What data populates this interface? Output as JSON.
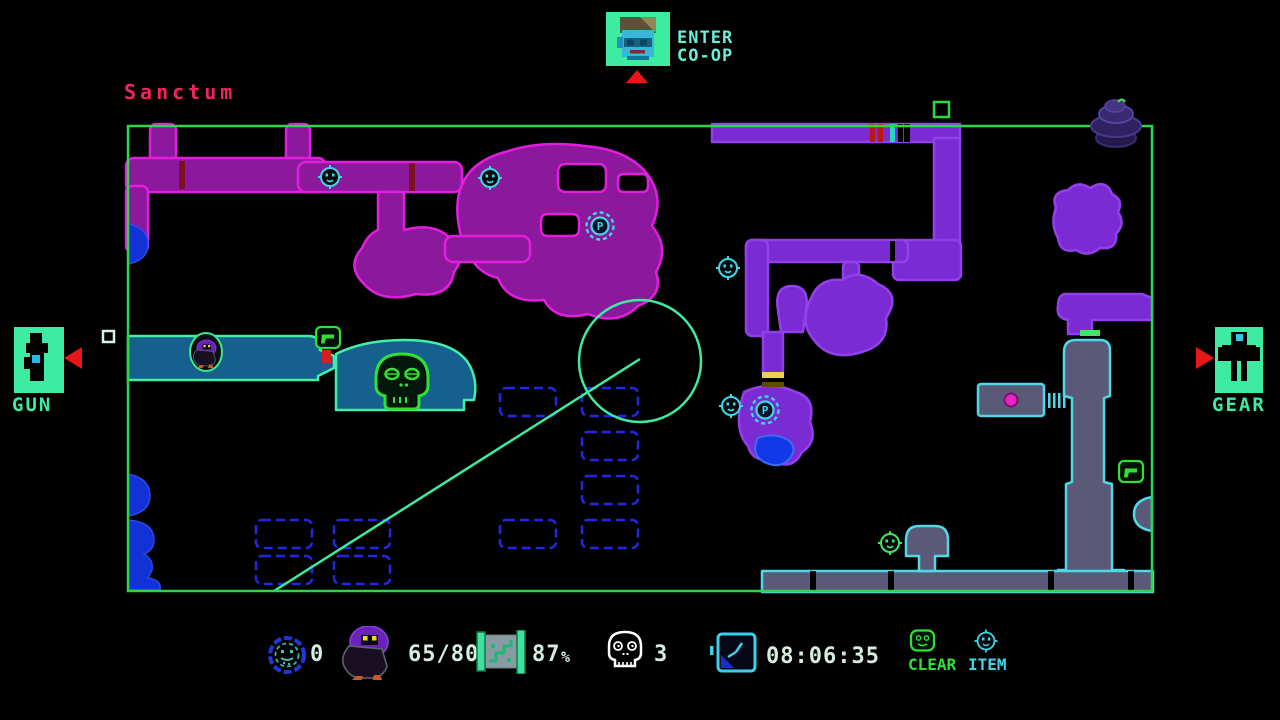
{
  "header": {
    "area_name": "Sanctum",
    "coop_line1": "ENTER",
    "coop_line2": "CO-OP"
  },
  "panels": {
    "left_label": "GUN",
    "right_label": "GEAR"
  },
  "map": {
    "teleport_label": "P"
  },
  "stats": {
    "rings": "0",
    "enemies": "65/80",
    "map_percent": "87",
    "map_percent_unit": "%",
    "deaths": "3",
    "time": "08:06:35"
  },
  "legend": {
    "clear_label": "CLEAR",
    "item_label": "ITEM"
  },
  "colors": {
    "border_green": "#29d846",
    "room_magenta_outline": "#e11ede",
    "room_magenta_fill": "#8c189c",
    "room_violet_outline": "#9440ea",
    "room_violet_fill": "#7a2bd4",
    "room_teal_outline": "#40f0a8",
    "room_teal_fill": "#15608c",
    "room_gray_outline": "#4fd9e8",
    "room_gray_fill": "#5a5a78",
    "unexplored_blue": "#2327e0",
    "solid_blue": "#1232d8",
    "accent_red": "#e81616",
    "panel_green": "#3deba1",
    "title_red": "#f2255a",
    "hud_text": "#d6eee0",
    "clear_green": "#2fe135",
    "item_cyan": "#3dd8e8"
  },
  "icons": {
    "coop_portrait": "pilot-portrait-icon",
    "gun": "gun-icon",
    "gear": "gear-icon",
    "rings_counter": "ring-icon",
    "enemies_counter": "creature-icon",
    "map_counter": "map-scroll-icon",
    "deaths_counter": "skull-icon",
    "timer": "clock-icon",
    "legend_clear": "clear-marker-icon",
    "legend_item": "item-marker-icon",
    "map_teleport": "teleport-p-icon",
    "map_saucer": "saucer-icon"
  }
}
